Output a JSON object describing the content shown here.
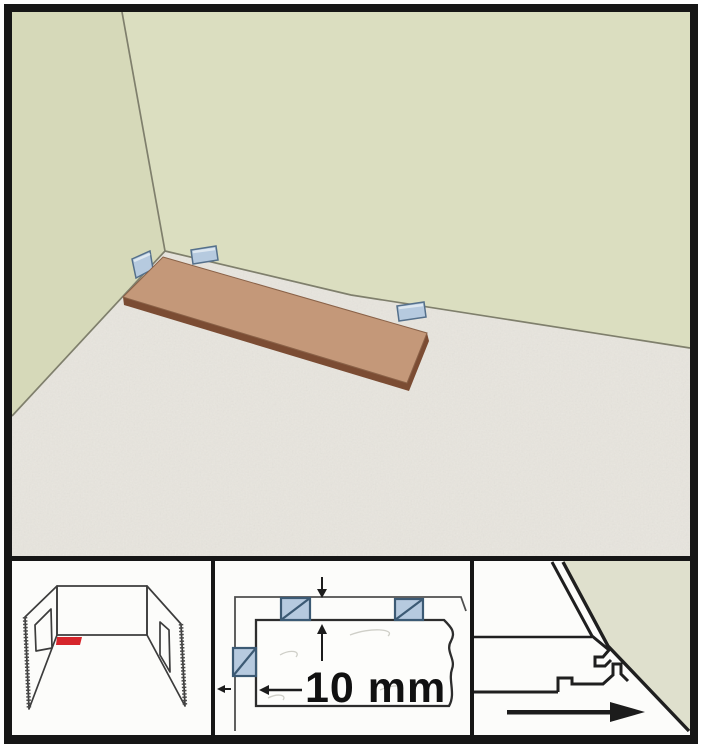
{
  "figure": {
    "kind": "flooring-installation-step-diagram",
    "main_scene": "room corner with first laminate plank laid on underlay floor, separated from walls by spacer wedges",
    "insets": {
      "room_sketch": "perspective sketch of room with window and door, red plank marks starting corner",
      "top_view": "top view of plank corner with three spacer blocks and expansion gap dimension",
      "profile_view": "cross-section of plank click profile angled against wall with laying direction arrow"
    }
  },
  "measurement": {
    "label": "10 mm"
  },
  "icons": {
    "gap_arrow_down": "arrow-down",
    "gap_arrow_up": "arrow-up",
    "gap_arrow_left_small": "arrow-left",
    "dimension_arrow_left": "arrow-left",
    "direction_arrow_right": "arrow-right"
  },
  "colors": {
    "frame": "#161616",
    "wall_left": "#d6d9b9",
    "wall_right": "#dbdec0",
    "wall_edge_line": "#7f7f6c",
    "floor_base": "#e6e3dc",
    "plank_top": "#c49879",
    "plank_side": "#7b4c33",
    "plank_outline": "#8a6248",
    "spacer_fill": "#b6cadf",
    "spacer_border": "#55708b",
    "spacer_highlight": "#dde7f0",
    "inset_bg": "#fcfcfa",
    "sketch_line": "#3c3c3c",
    "red_highlight": "#d6252b",
    "topview_plank_line": "#2d2d2d",
    "profile_wall_fill": "#dfe0cd",
    "arrow": "#1c1c1c"
  }
}
